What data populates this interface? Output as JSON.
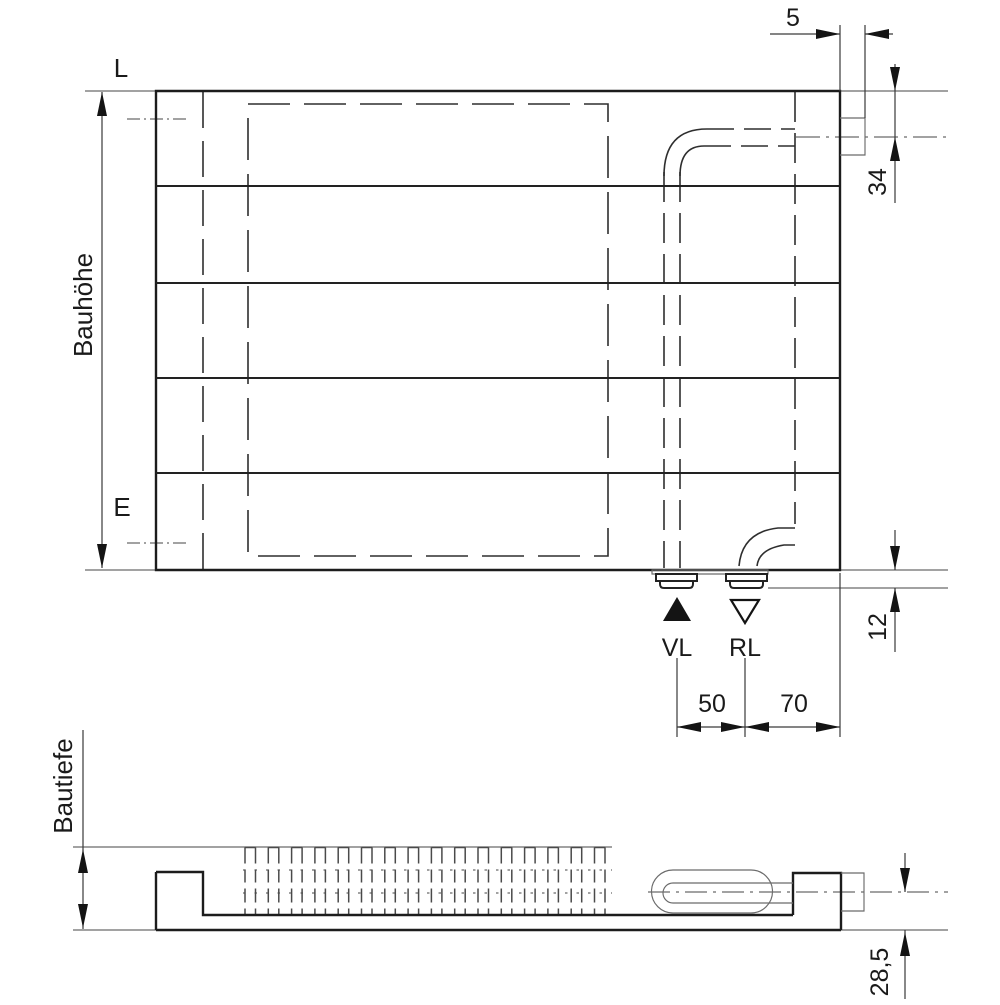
{
  "drawing": {
    "kind": "radiator dimensional drawing",
    "views": [
      "front elevation",
      "depth section"
    ]
  },
  "front_view": {
    "label_length": "L",
    "label_height": "Bauhöhe",
    "label_hook": "E",
    "label_supply": "VL",
    "label_return": "RL",
    "dim_tab_width": "5",
    "dim_axis_from_top": "34",
    "dim_nipple_drop": "12",
    "dim_vl_to_rl": "50",
    "dim_rl_to_edge": "70",
    "icon_supply": "filled-up-triangle",
    "icon_return": "open-down-triangle",
    "panel_sections": 5
  },
  "top_view": {
    "label_depth": "Bautiefe",
    "dim_axis_above_bottom": "28,5",
    "fin_count": 16
  },
  "colors": {
    "background": "#ffffff",
    "outline": "#1c1c1c",
    "hidden_lines": "#2e2e2e",
    "reference_lines": "#6b6b6b",
    "text": "#1a1a1a"
  }
}
